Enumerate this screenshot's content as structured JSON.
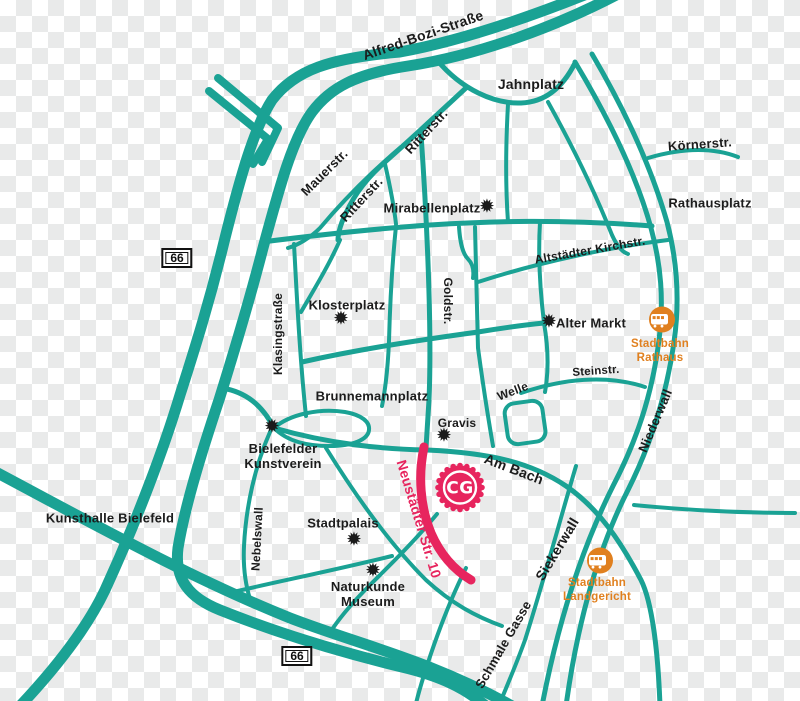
{
  "colors": {
    "road": "#1AA294",
    "highlight": "#E7255E",
    "transit": "#E0801F",
    "ink": "#1C1C1C",
    "checker": "#E9EAEA",
    "shield_bg": "#FFFFFF",
    "shield_border": "#111111"
  },
  "map": {
    "labels": {
      "alfred_bozi": "Alfred-Bozi-Straße",
      "jahnplatz": "Jahnplatz",
      "koernerstr": "Körnerstr.",
      "rathausplatz": "Rathausplatz",
      "mauerstr": "Mauerstr.",
      "ritterstr_upper": "Ritterstr.",
      "ritterstr_lower": "Ritterstr.",
      "mirabellenplatz": "Mirabellenplatz",
      "altstaedter_kirchstr": "Altstädter Kirchstr.",
      "klosterplatz": "Klosterplatz",
      "klasingstrasse": "Klasingstraße",
      "goldstr": "Goldstr.",
      "alter_markt": "Alter Markt",
      "steinstr": "Steinstr.",
      "niederwall": "Niederwall",
      "brunnemannplatz": "Brunnemannplatz",
      "welle": "Welle",
      "gravis": "Gravis",
      "kunstverein_line1": "Bielefelder",
      "kunstverein_line2": "Kunstverein",
      "am_bach": "Am Bach",
      "neustaedter": "Neustädter Str. 10",
      "kunsthalle": "Kunsthalle Bielefeld",
      "stadtpalais": "Stadtpalais",
      "nebelswall": "Nebelswall",
      "naturkunde_line1": "Naturkunde",
      "naturkunde_line2": "Museum",
      "siekerwall": "Siekerwall",
      "schmale_gasse": "Schmale Gasse"
    },
    "transit_stops": [
      {
        "line1": "Stadtbahn",
        "line2": "Rathaus"
      },
      {
        "line1": "Stadtbahn",
        "line2": "Landgericht"
      }
    ],
    "route_shields": [
      {
        "number": "66"
      },
      {
        "number": "66"
      }
    ],
    "logo": {
      "text": "CG"
    },
    "poi_marker_glyph": "✹"
  }
}
